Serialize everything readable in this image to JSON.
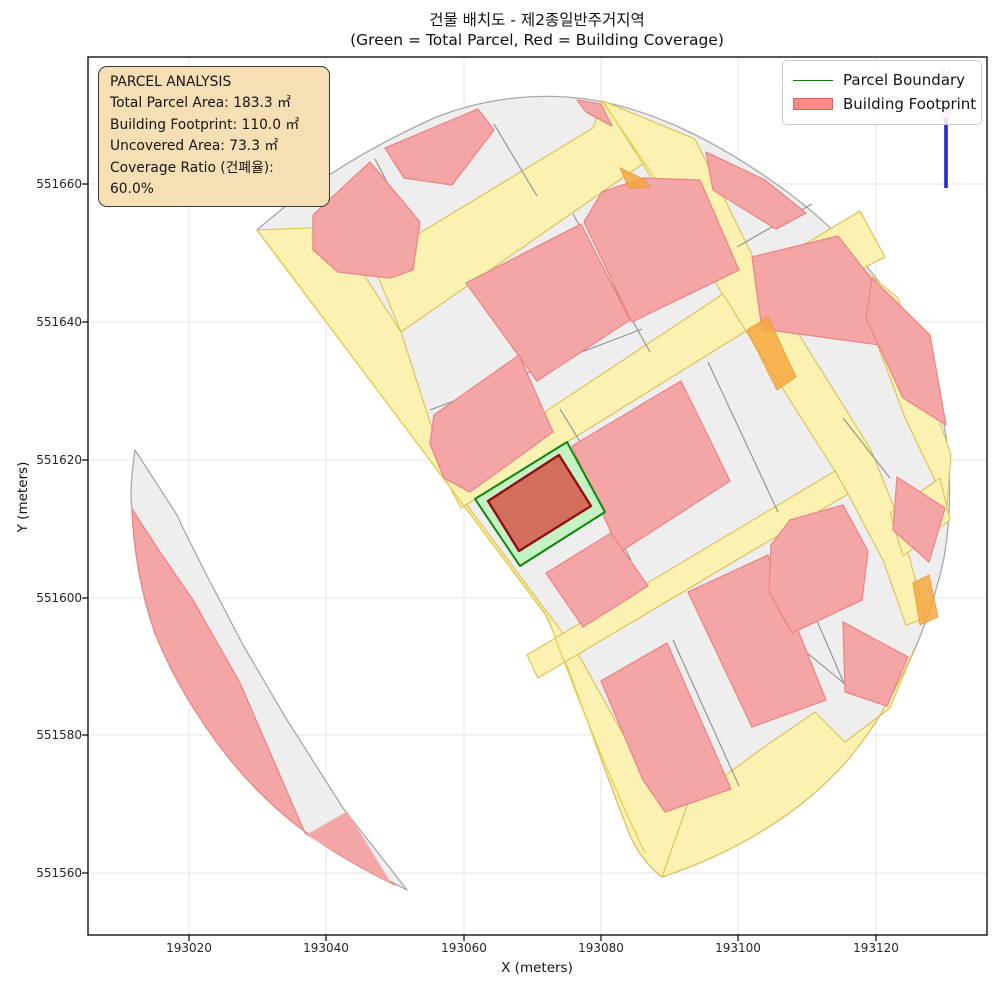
{
  "figure": {
    "title_line1": "건물 배치도 - 제2종일반주거지역",
    "title_line2": "(Green = Total Parcel, Red = Building Coverage)"
  },
  "axes": {
    "x_label": "X (meters)",
    "y_label": "Y (meters)",
    "x_ticks": [
      "193020",
      "193040",
      "193060",
      "193080",
      "193100",
      "193120"
    ],
    "y_ticks": [
      "551660",
      "551640",
      "551620",
      "551600",
      "551580",
      "551560"
    ]
  },
  "legend": {
    "items": [
      {
        "label": "Parcel Boundary",
        "swatch": "green-line"
      },
      {
        "label": "Building Footprint",
        "swatch": "red-patch"
      }
    ]
  },
  "analysis_box": {
    "title": "PARCEL ANALYSIS",
    "lines": [
      "Total Parcel Area: 183.3 ㎡",
      "Building Footprint: 110.0 ㎡",
      "Uncovered Area: 73.3 ㎡",
      "Coverage Ratio (건폐율): 60.0%"
    ]
  },
  "compass": {
    "label": "N"
  },
  "colors": {
    "parcel_fill": "#efeeee",
    "road_fill": "#fbf2b2",
    "building_fill": "#f4a6a6",
    "orange_accent": "#f6a93f",
    "highlight_parcel_fill": "#c4f2c4",
    "highlight_parcel_stroke": "#0f860f",
    "highlight_building_fill": "#d46f5e",
    "highlight_building_stroke": "#8e1010",
    "north_arrow": "#2626d8",
    "analysis_box_bg": "#f6dfb4",
    "legend_line_green": "#157515",
    "legend_patch_red": "#f88a8a"
  }
}
